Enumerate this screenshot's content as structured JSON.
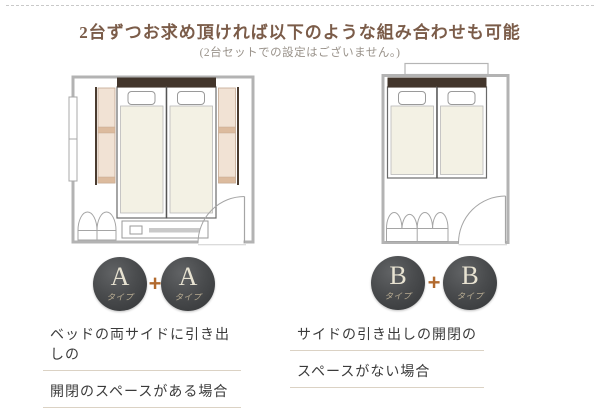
{
  "header": {
    "title": "2台ずつお求め頂ければ以下のような組み合わせも可能",
    "subtitle": "(2台セットでの設定はございません。)"
  },
  "combo_a": {
    "badges": [
      {
        "letter": "A",
        "sub": "タイプ"
      },
      {
        "letter": "A",
        "sub": "タイプ"
      }
    ],
    "plus": "+",
    "caption_lines": [
      "ベッドの両サイドに引き出しの",
      "開閉のスペースがある場合"
    ]
  },
  "combo_b": {
    "badges": [
      {
        "letter": "B",
        "sub": "タイプ"
      },
      {
        "letter": "B",
        "sub": "タイプ"
      }
    ],
    "plus": "+",
    "caption_lines": [
      "サイドの引き出しの開閉の",
      "スペースがない場合"
    ]
  },
  "colors": {
    "title_brown": "#7b5c49",
    "plus_orange": "#b26a2e",
    "badge_dark_gray": "#45474a",
    "badge_letter_cream": "#e8e3d2",
    "wall_gray": "#b3b3b3",
    "headboard_brown": "#42352b",
    "mattress_ivory": "#f3f1e4",
    "drawer_tan": "#f1e2d4",
    "drawer_bar_tan": "#dcbb9e",
    "caption_rule": "#dbd2c4"
  }
}
